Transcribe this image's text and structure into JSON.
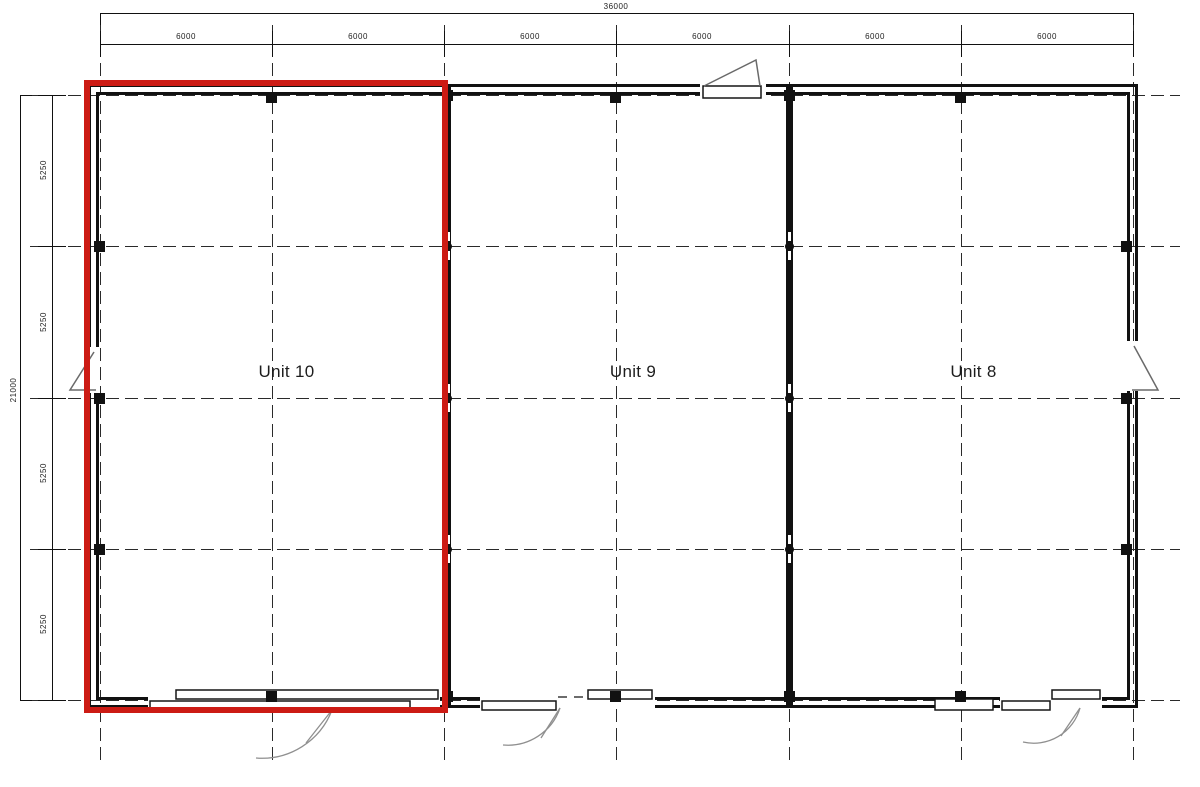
{
  "plan": {
    "units": [
      {
        "label": "Unit 10",
        "highlighted": true
      },
      {
        "label": "Unit 9",
        "highlighted": false
      },
      {
        "label": "Unit 8",
        "highlighted": false
      }
    ],
    "dimensions": {
      "overall_width": "36000",
      "overall_height": "21000",
      "top_segments": [
        "6000",
        "6000",
        "6000",
        "6000",
        "6000",
        "6000"
      ],
      "left_segments": [
        "5250",
        "5250",
        "5250",
        "5250"
      ]
    },
    "colors": {
      "highlight_red": "#cc1b14",
      "wall_black": "#111111"
    }
  }
}
